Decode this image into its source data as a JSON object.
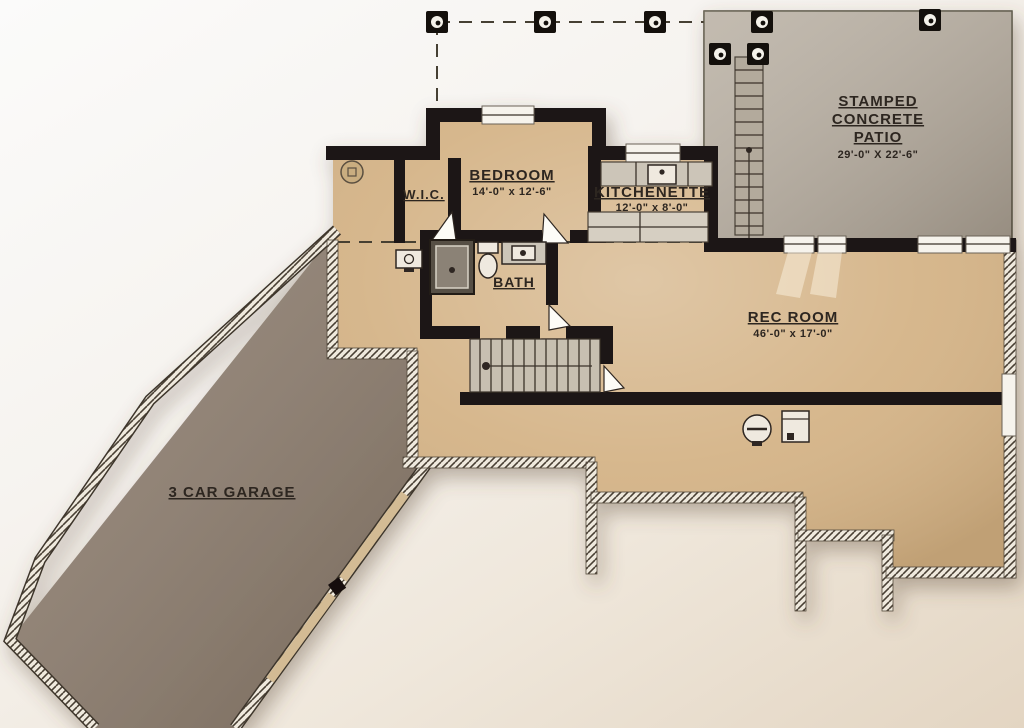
{
  "rooms": {
    "bedroom": {
      "label": "BEDROOM",
      "dims": "14'-0\" x 12'-6\""
    },
    "wic": {
      "label": "W.I.C."
    },
    "kitchenette": {
      "label": "KITCHENETTE",
      "dims": "12'-0\" x 8'-0\""
    },
    "bath": {
      "label": "BATH"
    },
    "rec_room": {
      "label": "REC ROOM",
      "dims": "46'-0\" x 17'-0\""
    },
    "garage": {
      "label": "3 CAR GARAGE"
    },
    "patio": {
      "line1": "STAMPED",
      "line2": "CONCRETE",
      "line3": "PATIO",
      "dims": "29'-0\" X 22'-6\""
    }
  },
  "colors": {
    "floor_tan": "#d3b183",
    "garage_floor": "#8b7b6c",
    "patio_floor": "#b9b0a3",
    "wall": "#1d1712",
    "label": "#2d2620"
  }
}
